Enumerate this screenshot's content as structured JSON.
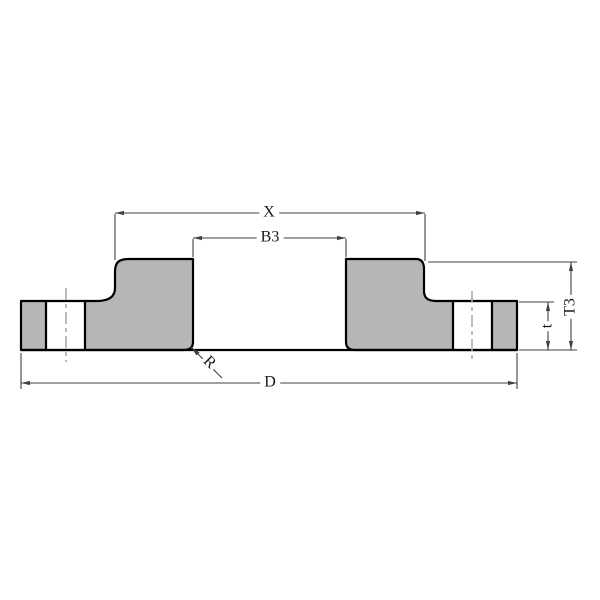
{
  "diagram": {
    "labels": {
      "hub_width": "X",
      "bore": "B3",
      "outer_diameter": "D",
      "plate_thickness": "t",
      "overall_thickness": "T3",
      "fillet_radius": "R"
    },
    "colors": {
      "background": "#ffffff",
      "fill": "#b6b6b6",
      "outline": "#000000",
      "dimension": "#404040",
      "centerline": "#ababab",
      "text": "#1a1a1a"
    }
  }
}
